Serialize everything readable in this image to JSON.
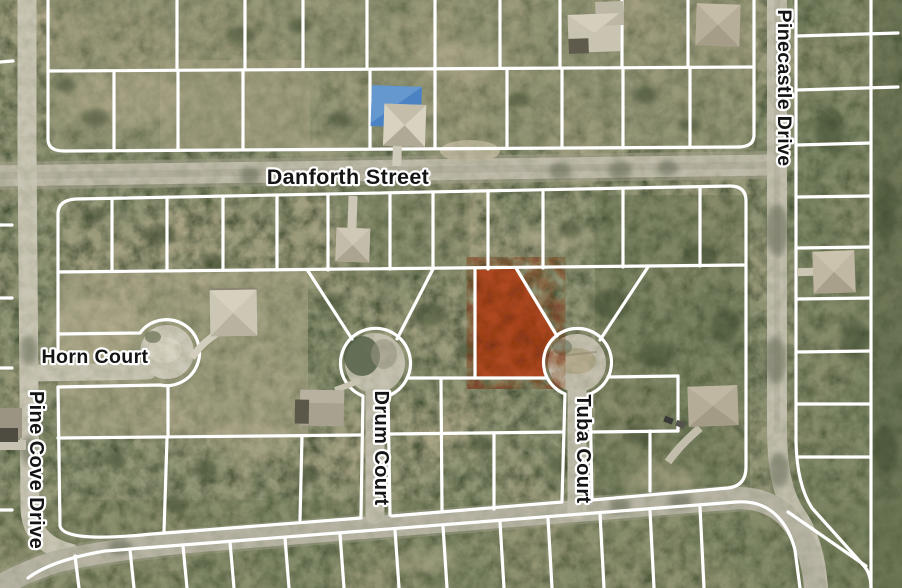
{
  "map": {
    "kind": "aerial-parcel-map",
    "colors": {
      "parcel_line": "#ffffff",
      "highlighted_parcel": "#b2431d",
      "label_text": "#141414",
      "label_halo": "#ffffff"
    }
  },
  "streets": {
    "danforth": "Danforth Street",
    "pinecastle": "Pinecastle Drive",
    "horn": "Horn Court",
    "pine_cove": "Pine Cove Drive",
    "drum": "Drum Court",
    "tuba": "Tuba Court"
  }
}
